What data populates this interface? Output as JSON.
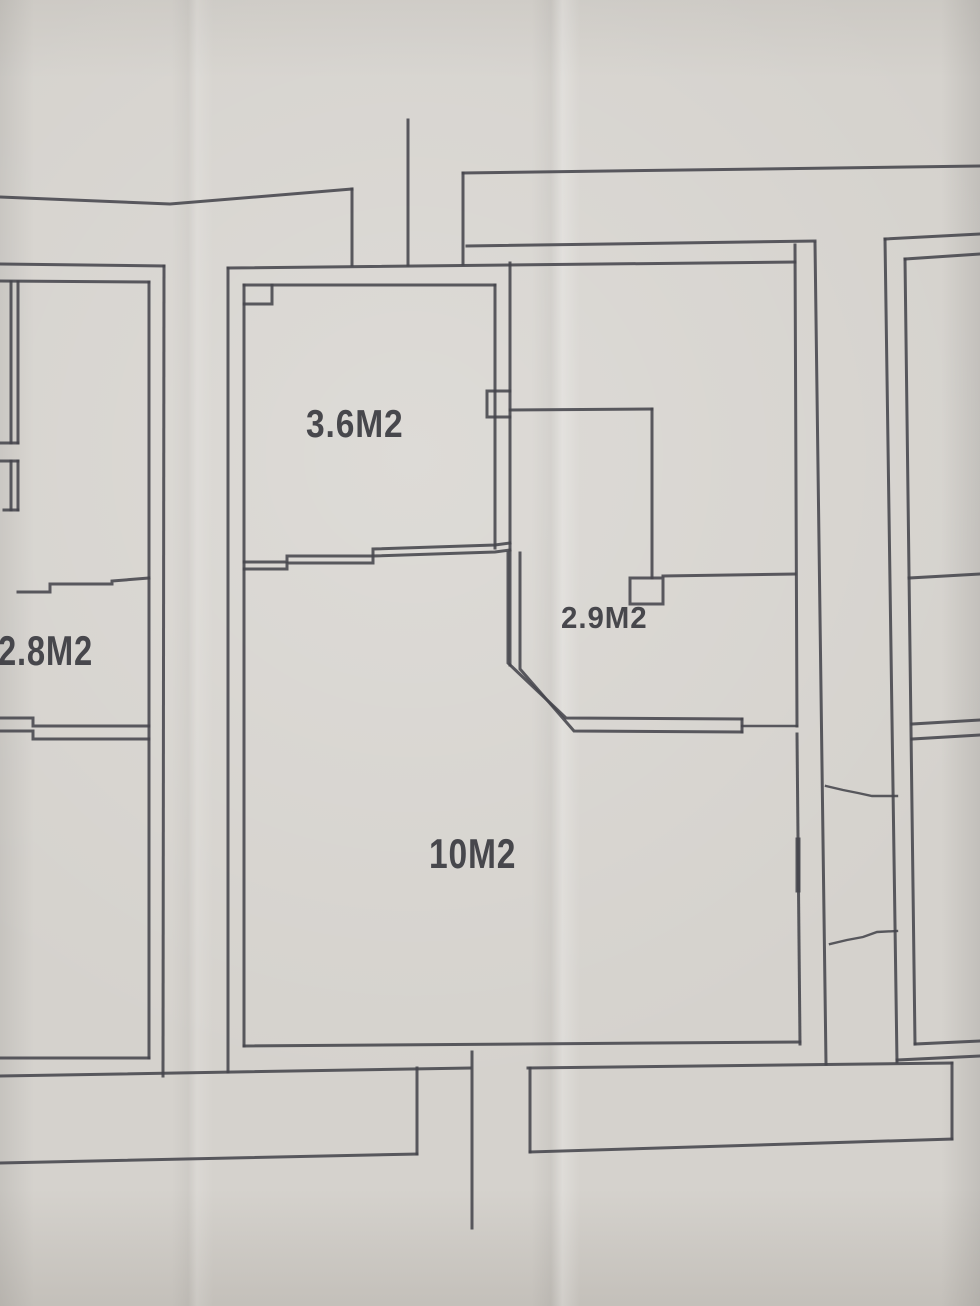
{
  "rooms": [
    {
      "id": "top-room",
      "label": "3.6M2"
    },
    {
      "id": "hall",
      "label": "2.9M2"
    },
    {
      "id": "left-room",
      "label": "2.8M2"
    },
    {
      "id": "main-room",
      "label": "10M2"
    }
  ],
  "colors": {
    "paper": "#d5d2cd",
    "line": "#45454c",
    "text": "#3b3b41"
  }
}
